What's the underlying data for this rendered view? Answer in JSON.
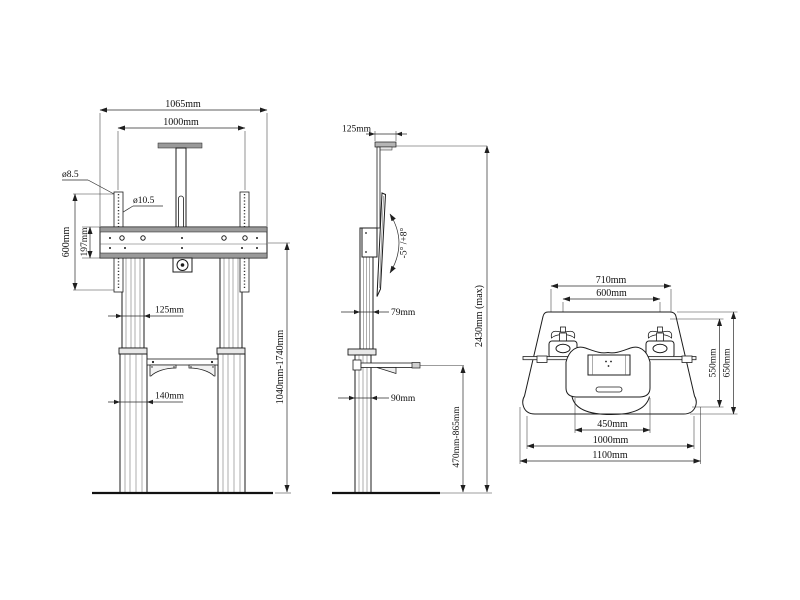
{
  "drawing": {
    "front_view": {
      "dim_overall_width": "1065mm",
      "dim_mount_width": "1000mm",
      "dim_hole_small": "ø8.5",
      "dim_hole_large": "ø10.5",
      "dim_bracket_height": "600mm",
      "dim_crossbar_height": "197mm",
      "dim_upper_column_width": "125mm",
      "dim_lower_column_width": "140mm",
      "dim_height_range": "1040mm-1740mm"
    },
    "side_view": {
      "dim_top_bracket_depth": "125mm",
      "dim_tilt_range": "-5° /+8°",
      "dim_column_depth": "79mm",
      "dim_lower_column_depth": "90mm",
      "dim_shelf_height_range": "470mm-865mm",
      "dim_max_height": "2430mm (max)"
    },
    "top_view": {
      "dim_caster_outer_spacing": "710mm",
      "dim_caster_center_spacing": "600mm",
      "dim_inner_width": "450mm",
      "dim_base_width": "1000mm",
      "dim_overall_width": "1100mm",
      "dim_inner_depth": "550mm",
      "dim_overall_depth": "650mm"
    }
  }
}
